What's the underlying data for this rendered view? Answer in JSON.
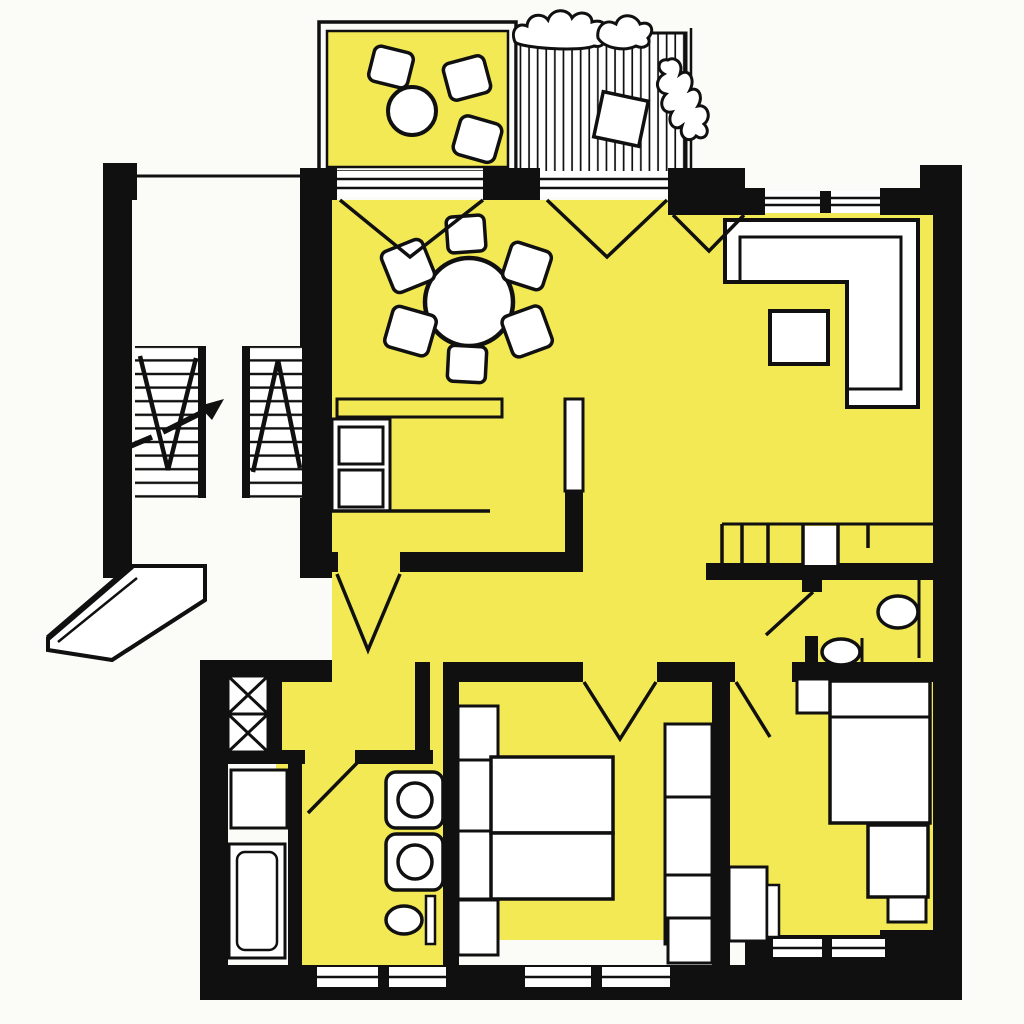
{
  "document": {
    "type": "apartment-floor-plan",
    "style": "hand-drawn ink drawing, apartment interior highlighted in yellow",
    "text_labels": []
  },
  "colors": {
    "highlight": "#F2E954",
    "wall": "#101010",
    "paper": "#FBFBF8",
    "fixture": "#FFFFFF"
  },
  "rooms": [
    {
      "id": "balcony-terrace",
      "floor": "yellow",
      "furniture": [
        "round-table",
        "stool",
        "stool",
        "stool"
      ]
    },
    {
      "id": "wood-deck-balcony",
      "floor": "wood-planks",
      "furniture": [
        "shrub-planting",
        "shrub-planting",
        "square-planter"
      ]
    },
    {
      "id": "living-dining-room",
      "floor": "yellow",
      "furniture": [
        "dining-table",
        "dining-chair x6",
        "corner-sofa",
        "coffee-table"
      ]
    },
    {
      "id": "kitchen",
      "floor": "yellow",
      "furniture": [
        "counter",
        "cooktop-sink-unit",
        "pass-through-divider"
      ]
    },
    {
      "id": "entrance-hall",
      "floor": "yellow",
      "furniture": [
        "built-in-closet"
      ]
    },
    {
      "id": "wc",
      "floor": "yellow",
      "furniture": [
        "washbasin",
        "toilet"
      ]
    },
    {
      "id": "bathroom",
      "floor": "yellow",
      "furniture": [
        "washbasin",
        "washbasin",
        "toilet"
      ]
    },
    {
      "id": "utility-room",
      "floor": "white",
      "furniture": [
        "washing-machine",
        "bathtub"
      ]
    },
    {
      "id": "main-bedroom",
      "floor": "yellow",
      "furniture": [
        "double-bed",
        "nightstand",
        "nightstand",
        "wardrobe"
      ]
    },
    {
      "id": "second-bedroom",
      "floor": "yellow",
      "furniture": [
        "single-bed",
        "nightstand",
        "desk",
        "chair",
        "dresser"
      ]
    },
    {
      "id": "stairwell",
      "floor": "white",
      "furniture": [
        "stair-flights",
        "direction-arrow"
      ]
    },
    {
      "id": "entrance-porch",
      "floor": "white",
      "furniture": []
    },
    {
      "id": "ventilation-shaft",
      "floor": "white",
      "furniture": [
        "x-cross",
        "x-cross"
      ]
    }
  ],
  "openings": {
    "balcony_doors": 2,
    "windows_top": 1,
    "windows_bottom": 3,
    "interior_door_swings": 7
  }
}
